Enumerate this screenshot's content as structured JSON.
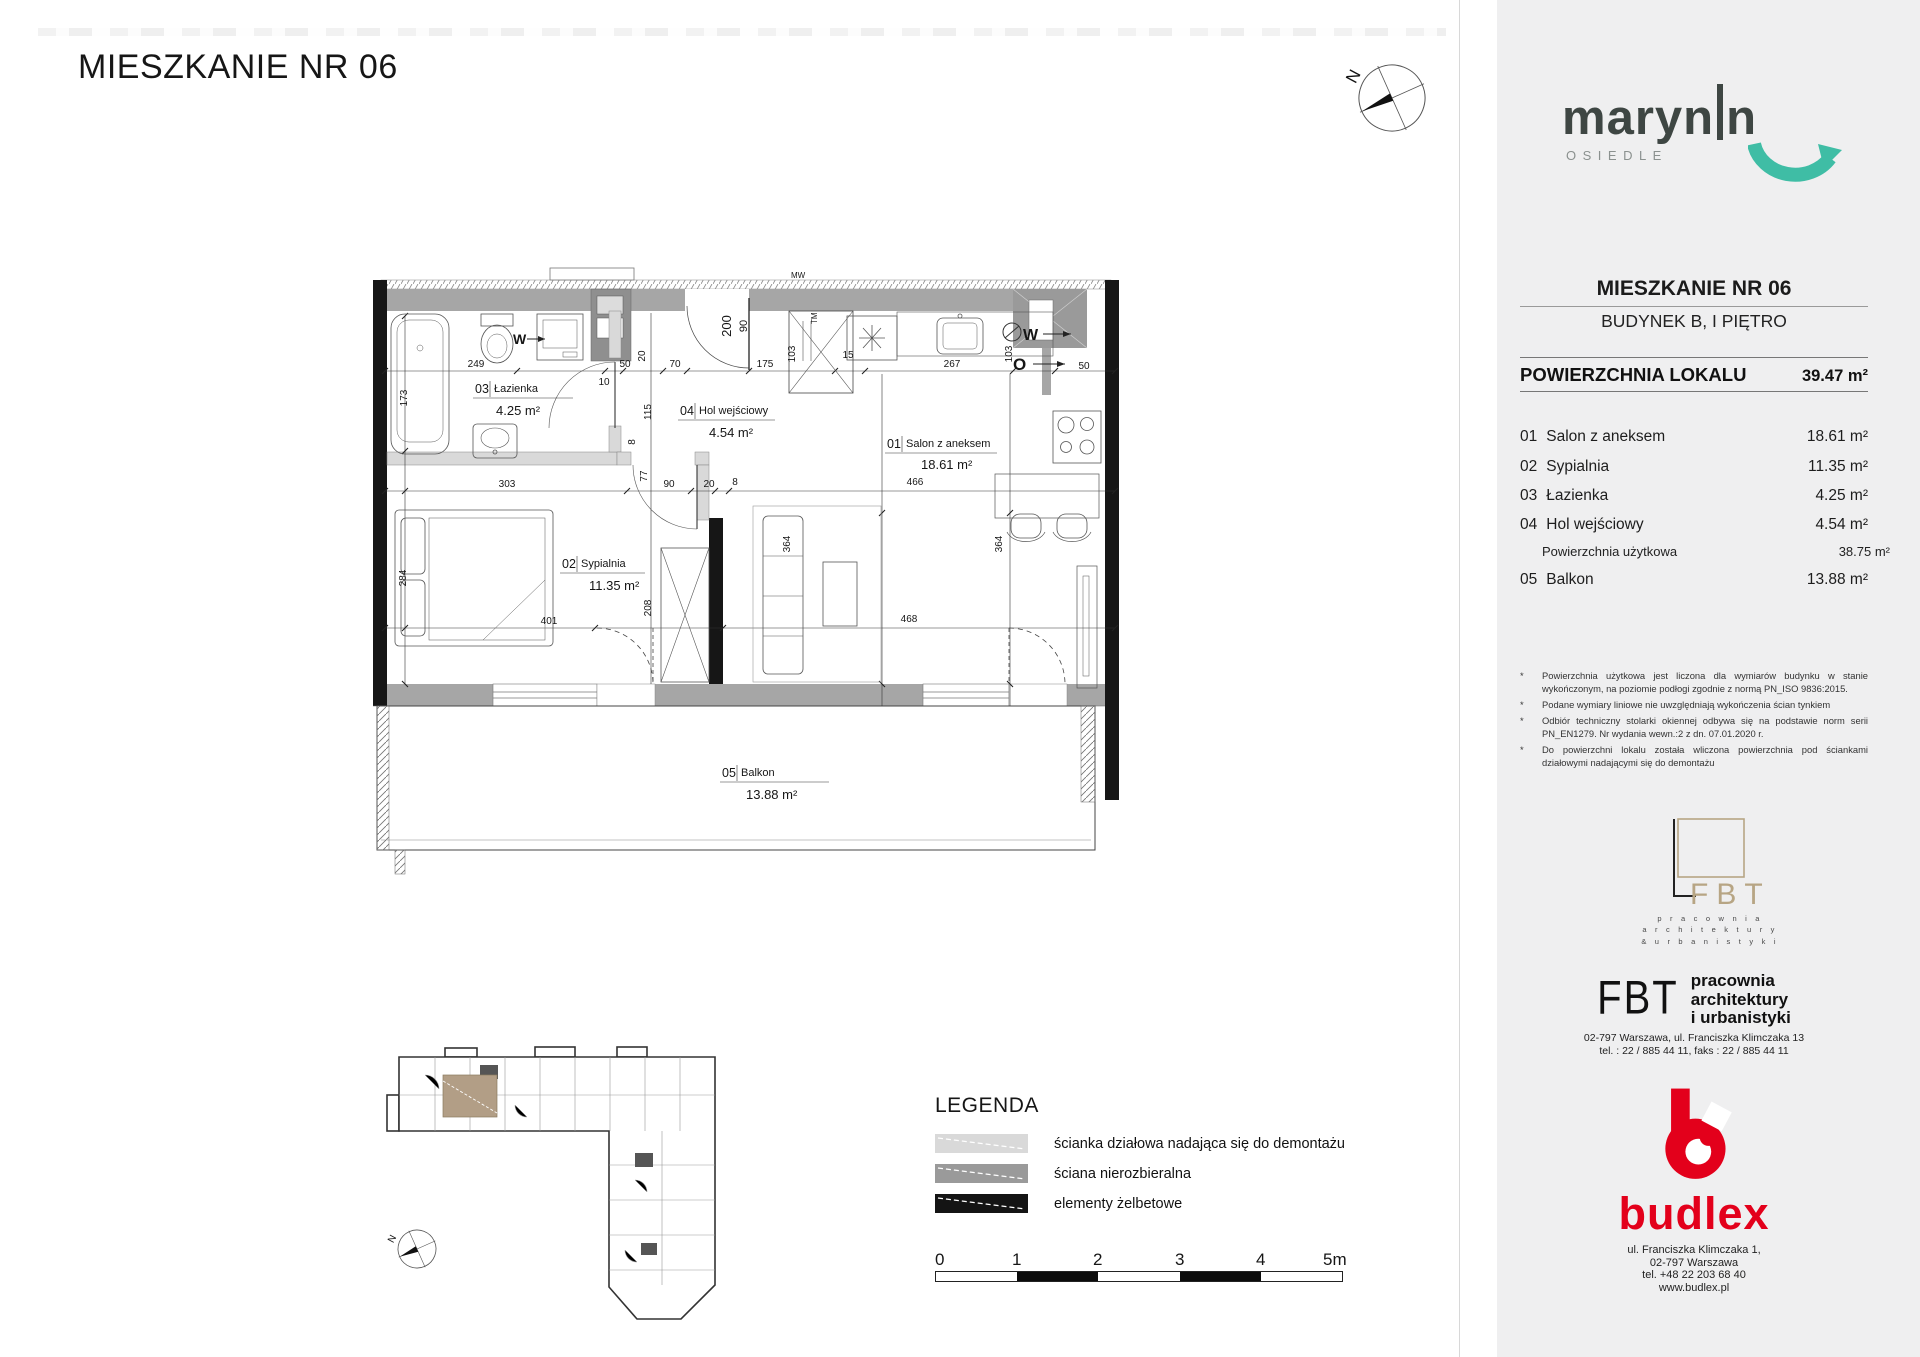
{
  "header": {
    "title": "MIESZKANIE NR 06"
  },
  "compass": {
    "north": "N",
    "north_mini": "N"
  },
  "sidebar": {
    "brand": {
      "name": "marynin",
      "part1": "maryn",
      "part2": "n",
      "subtitle": "OSIEDLE"
    },
    "unit_title": "MIESZKANIE NR 06",
    "unit_subtitle": "BUDYNEK B, I PIĘTRO",
    "area_header": {
      "label": "POWIERZCHNIA LOKALU",
      "value": "39.47 m²"
    },
    "rooms": [
      {
        "no": "01",
        "name": "Salon z aneksem",
        "area": "18.61 m²"
      },
      {
        "no": "02",
        "name": "Sypialnia",
        "area": "11.35 m²"
      },
      {
        "no": "03",
        "name": "Łazienka",
        "area": "4.25 m²"
      },
      {
        "no": "04",
        "name": "Hol wejściowy",
        "area": "4.54 m²"
      },
      {
        "no": "",
        "name": "Powierzchnia użytkowa",
        "area": "38.75 m²"
      },
      {
        "no": "05",
        "name": "Balkon",
        "area": "13.88 m²"
      }
    ],
    "footnotes": [
      "Powierzchnia użytkowa jest liczona dla wymiarów budynku w stanie wykończonym, na poziomie podłogi zgodnie z normą PN_ISO 9836:2015.",
      "Podane wymiary liniowe nie uwzględniają wykończenia ścian tynkiem",
      "Odbiór techniczny stolarki okiennej odbywa się na podstawie norm serii PN_EN1279. Nr wydania wewn.:2 z dn. 07.01.2020 r.",
      "Do powierzchni lokalu została wliczona powierzchnia pod ściankami działowymi nadającymi się do demontażu"
    ],
    "fbt_logo": {
      "letters": "FBT",
      "line1": "p r a c o w n i a",
      "line2": "a r c h i t e k t u r y",
      "line3": "& u r b a n i s t y k i"
    },
    "fbt_block": {
      "letters": "FBT",
      "name1": "pracownia",
      "name2": "architektury",
      "name3": "i urbanistyki",
      "address": "02-797 Warszawa, ul. Franciszka Klimczaka 13",
      "phones": "tel. : 22 / 885 44 11,   faks : 22 / 885 44 11"
    },
    "budlex": {
      "name": "budlex",
      "addr1": "ul. Franciszka Klimczaka 1,",
      "addr2": "02-797 Warszawa",
      "addr3": "tel. +48 22 203 68 40",
      "addr4": "www.budlex.pl"
    }
  },
  "plan": {
    "labels": [
      {
        "no": "01",
        "name": "Salon z aneksem",
        "area": "18.61 m²"
      },
      {
        "no": "02",
        "name": "Sypialnia",
        "area": "11.35 m²"
      },
      {
        "no": "03",
        "name": "Łazienka",
        "area": "4.25 m²"
      },
      {
        "no": "04",
        "name": "Hol wejściowy",
        "area": "4.54 m²"
      },
      {
        "no": "05",
        "name": "Balkon",
        "area": "13.88 m²"
      }
    ],
    "dims": {
      "h1": [
        "249",
        "50",
        "70",
        "10",
        "175",
        "15",
        "267",
        "50"
      ],
      "v1": [
        "173",
        "20",
        "115",
        "8",
        "200",
        "90",
        "103",
        "103"
      ],
      "h2": [
        "303",
        "90",
        "20",
        "8",
        "466"
      ],
      "v2": [
        "77",
        "364",
        "364"
      ],
      "h3": [
        "401",
        "468"
      ],
      "v3": [
        "284",
        "208"
      ]
    },
    "marks": {
      "mw": "MW",
      "tm": "TM",
      "washer": "W",
      "vent_w": "W",
      "vent_o": "O"
    }
  },
  "legend": {
    "title": "LEGENDA",
    "items": [
      {
        "label": "ścianka działowa nadająca się do demontażu",
        "color": "#d9d9d9"
      },
      {
        "label": "ściana nierozbieralna",
        "color": "#9a9a9a"
      },
      {
        "label": "elementy żelbetowe",
        "color": "#141414"
      }
    ]
  },
  "scalebar": {
    "labels": [
      "0",
      "1",
      "2",
      "3",
      "4",
      "5m"
    ]
  },
  "colors": {
    "sidebar_bg": "#efeff0",
    "brand_dark": "#3e4643",
    "accent_teal": "#3fbda5",
    "budlex_red": "#e3001b",
    "fbt_tan": "#b7a584",
    "wall_gray": "#a6a6a6",
    "wall_black": "#161616",
    "partition_light": "#d9d9d9",
    "overview_highlight": "#b29e86"
  }
}
